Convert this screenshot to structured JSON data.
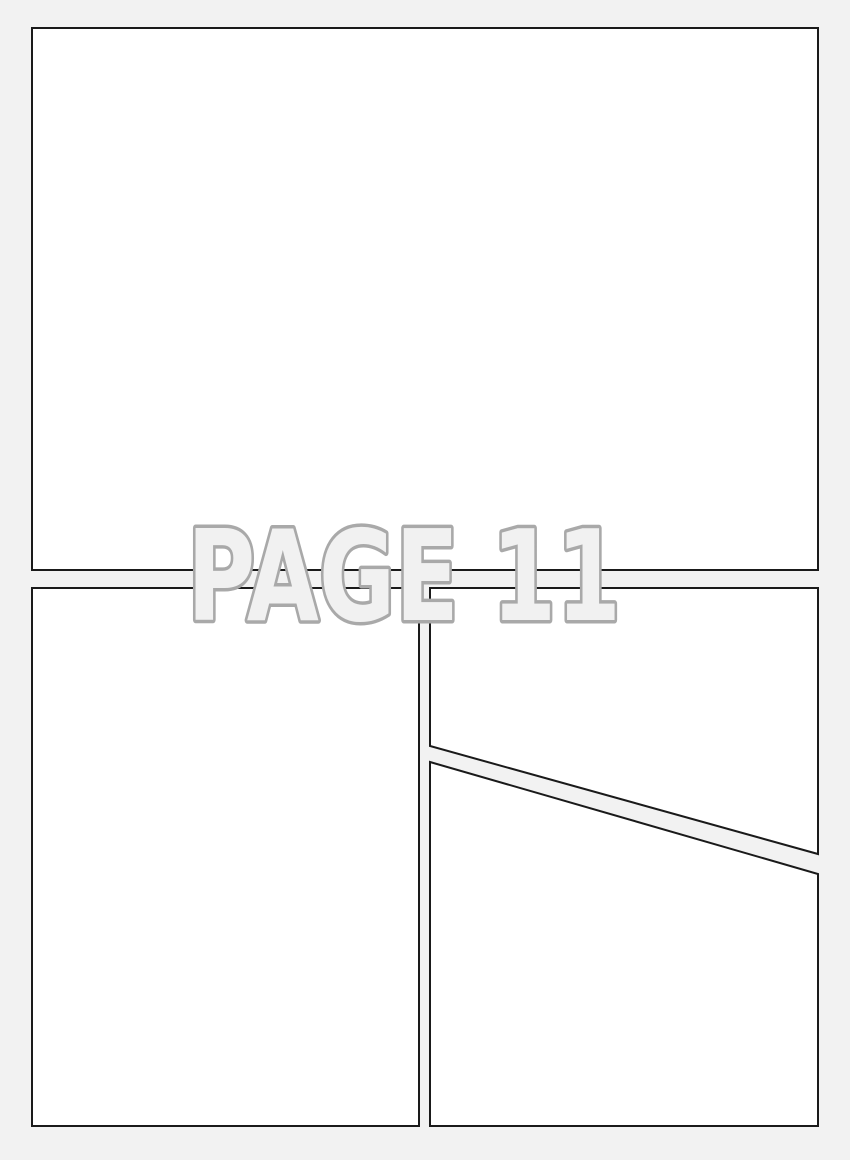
{
  "page": {
    "title": "PAGE 11",
    "page_number": "11"
  },
  "colors": {
    "background": "#f2f2f2",
    "panel_fill": "#ffffff",
    "panel_border": "#1a1a1a",
    "title_fill": "#f1f1f1",
    "title_outline": "#a9a9a9"
  },
  "panels": [
    {
      "id": "panel-1",
      "position": "top-full-width",
      "shape": "rectangle",
      "content": ""
    },
    {
      "id": "panel-2",
      "position": "bottom-left",
      "shape": "rectangle",
      "content": ""
    },
    {
      "id": "panel-3",
      "position": "bottom-right-upper",
      "shape": "diagonal-quad",
      "content": ""
    },
    {
      "id": "panel-4",
      "position": "bottom-right-lower",
      "shape": "diagonal-quad",
      "content": ""
    }
  ]
}
